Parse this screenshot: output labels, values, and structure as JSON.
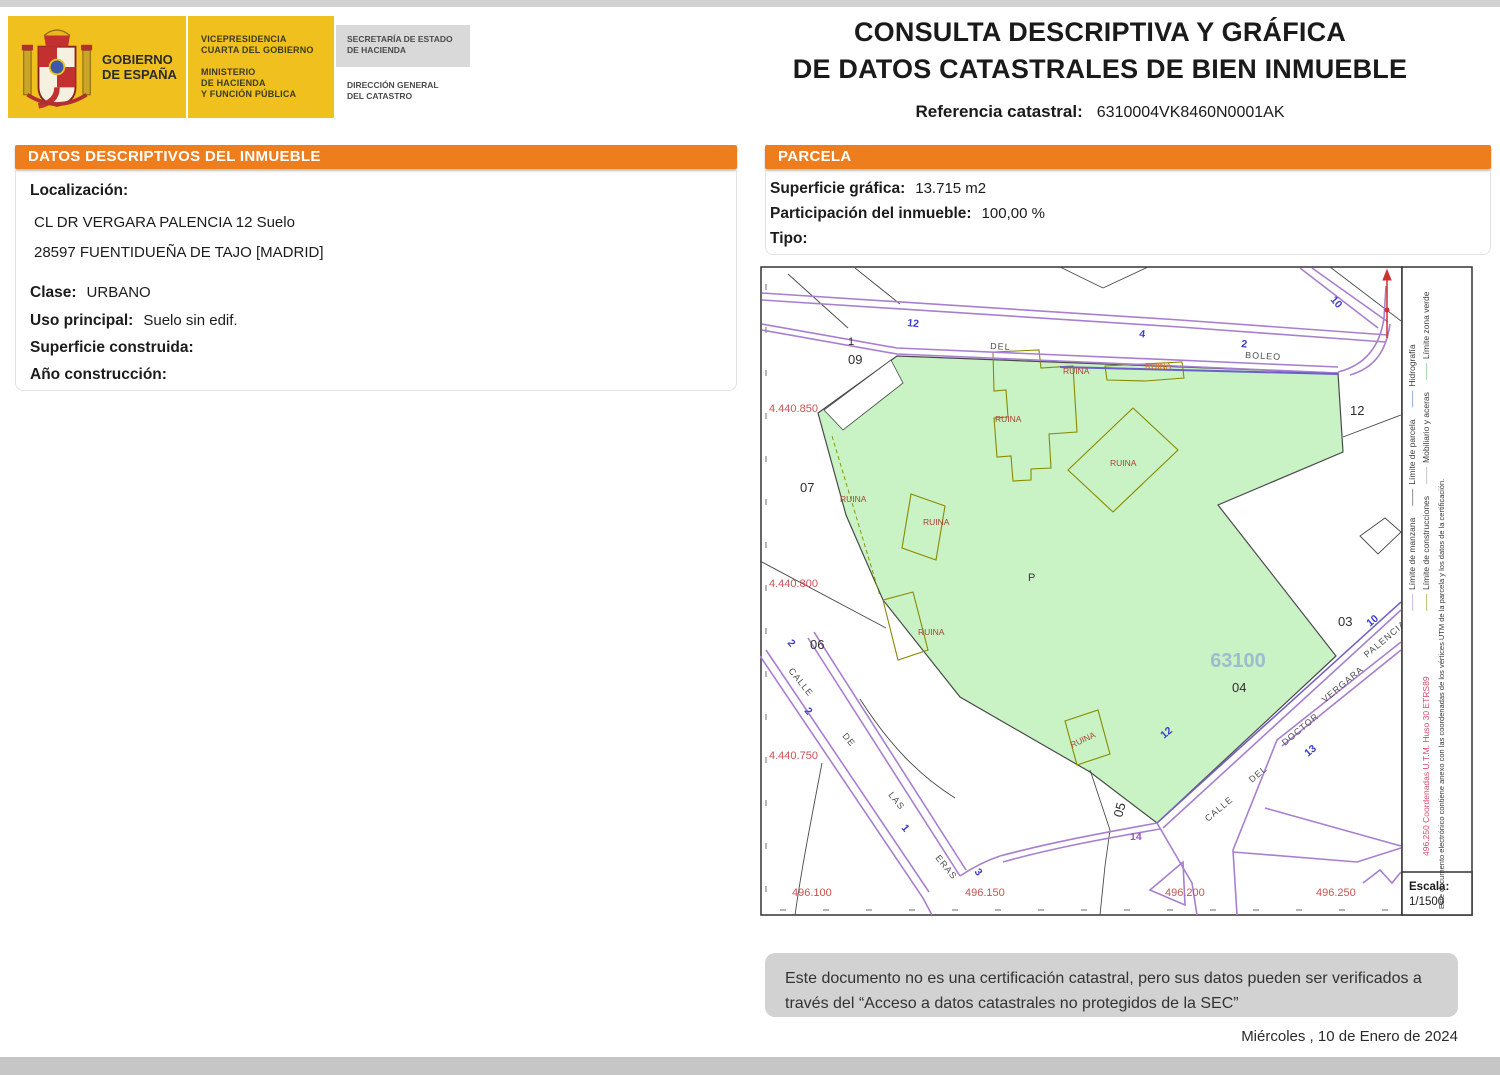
{
  "header": {
    "logo": {
      "gobierno1": "GOBIERNO",
      "gobierno2": "DE ESPAÑA",
      "vice1": "VICEPRESIDENCIA",
      "vice2": "CUARTA DEL GOBIERNO",
      "min1": "MINISTERIO",
      "min2": "DE HACIENDA",
      "min3": "Y FUNCIÓN PÚBLICA",
      "sec1": "SECRETARÍA DE ESTADO",
      "sec2": "DE HACIENDA",
      "dir1": "DIRECCIÓN GENERAL",
      "dir2": "DEL CATASTRO"
    },
    "title1": "CONSULTA DESCRIPTIVA Y GRÁFICA",
    "title2": "DE DATOS CATASTRALES DE BIEN INMUEBLE",
    "ref_label": "Referencia catastral:",
    "ref_value": "6310004VK8460N0001AK"
  },
  "left_panel": {
    "header": "DATOS DESCRIPTIVOS DEL INMUEBLE",
    "loc_label": "Localización:",
    "addr1": "CL DR VERGARA PALENCIA 12 Suelo",
    "addr2": "28597 FUENTIDUEÑA DE TAJO [MADRID]",
    "clase_label": "Clase:",
    "clase_value": "URBANO",
    "uso_label": "Uso principal:",
    "uso_value": "Suelo sin edif.",
    "sup_label": "Superficie construida:",
    "sup_value": "",
    "anio_label": "Año construcción:",
    "anio_value": ""
  },
  "parcela_panel": {
    "header": "PARCELA",
    "sup_label": "Superficie gráfica:",
    "sup_value": "13.715 m2",
    "part_label": "Participación del inmueble:",
    "part_value": "100,00 %",
    "tipo_label": "Tipo:",
    "tipo_value": ""
  },
  "map": {
    "streets": {
      "top_1": "DEL",
      "top_2": "BOLEO",
      "left_1": "CALLE",
      "left_2": "DE",
      "left_3": "LAS",
      "left_4": "ERAS",
      "right_1": "CALLE",
      "right_2": "DEL",
      "right_3": "DOCTOR",
      "right_4": "VERGARA",
      "right_5": "PALENCIA"
    },
    "blocks": {
      "b09": "09",
      "b07": "07",
      "b06": "06",
      "b12": "12",
      "b03": "03",
      "b04": "04",
      "b05": "05"
    },
    "numbers": {
      "n1": "1",
      "n2": "2",
      "n3": "3",
      "n4": "4",
      "n10": "10",
      "n12": "12",
      "n13": "13",
      "n14": "14"
    },
    "parcel": {
      "code": "63100",
      "letter": "P"
    },
    "ruina": "RUINA",
    "coords_y": {
      "c1": "4.440.850",
      "c2": "4.440.800",
      "c3": "4.440.750"
    },
    "coords_x": {
      "c1": "496.100",
      "c2": "496.150",
      "c3": "496.200",
      "c4": "496.250"
    },
    "colors": {
      "parcel_fill": "#c9f2c5",
      "street_line": "#a87fd0",
      "construction_line": "#8a8a00",
      "ruina_text": "#a84434",
      "ruina_text_alt": "#e07820",
      "coord_text": "#cc5252",
      "house_number": "#3d3dc8",
      "parcel_code": "#9ebbd0"
    }
  },
  "sidebar": {
    "legend_dash": "——",
    "legend_row1": [
      {
        "label": "Límite de manzana",
        "color": "#b27fd8"
      },
      {
        "label": "Límite de parcela",
        "color": "#3a3a3a"
      },
      {
        "label": "Hidrografía",
        "color": "#4a6fc8"
      }
    ],
    "legend_row2": [
      {
        "label": "Límite de construcciones",
        "color": "#8a8a00"
      },
      {
        "label": "Mobiliario y aceras",
        "color": "#9a9a9a"
      },
      {
        "label": "Límite zona verde",
        "color": "#58b058"
      }
    ],
    "utm_text": "496.250 Coordenadas U.T.M. Huso 30 ETRS89",
    "utm_color": "#d84a6a",
    "cert_text": "Este documento electrónico contiene anexo con las coordenadas de los vértices UTM de la parcela y los datos de la certificación.",
    "escala_label": "Escala:",
    "escala_value": "1/1500"
  },
  "footer": {
    "line1": "Este documento no es una certificación catastral, pero sus datos pueden ser verificados a",
    "line2": "través del “Acceso a datos catastrales no protegidos de la SEC”",
    "date": "Miércoles , 10 de Enero de 2024"
  },
  "accent_colors": {
    "section_header": "#ee7d1e",
    "gov_yellow": "#f0c11e"
  }
}
